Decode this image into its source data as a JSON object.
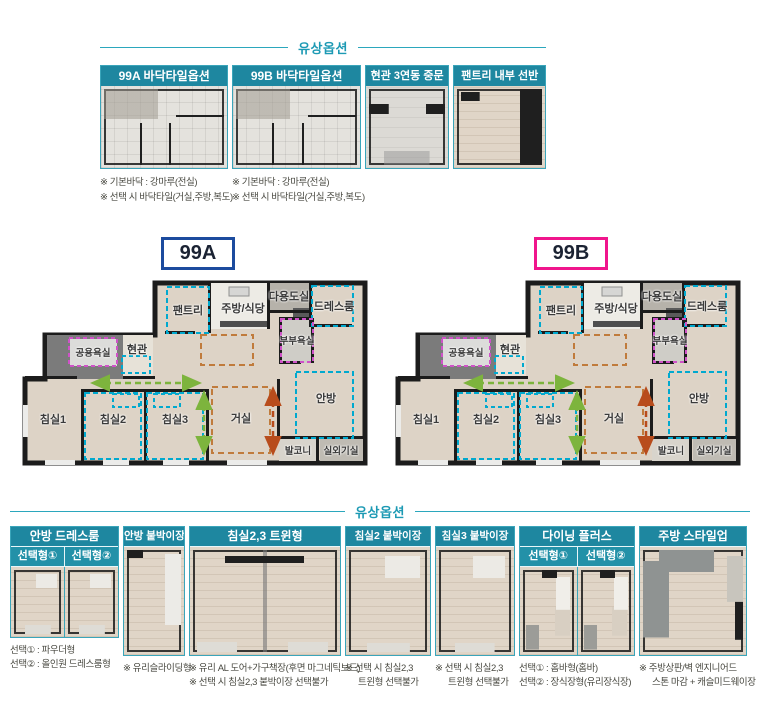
{
  "rooms": {
    "pantry": "팬트리",
    "kitchen": "주방/식당",
    "utility": "다용도실",
    "dress": "드레스룸",
    "master_bath": "부부욕실",
    "common_bath": "공용욕실",
    "entrance": "현관",
    "bed1": "침실1",
    "bed2": "침실2",
    "bed3": "침실3",
    "living": "거실",
    "master": "안방",
    "balcony": "발코니",
    "outdoor_unit": "실외기실"
  },
  "plans": [
    {
      "label": "99A"
    },
    {
      "label": "99B"
    }
  ],
  "top_options": {
    "section_title": "유상옵션",
    "items": [
      {
        "title": "99A 바닥타일옵션"
      },
      {
        "title": "99B 바닥타일옵션"
      },
      {
        "title": "현관 3연동 중문"
      },
      {
        "title": "팬트리 내부 선반"
      }
    ],
    "notes_a": [
      "※ 기본바닥 : 강마루(전실)",
      "※ 선택 시 바닥타일(거실,주방,복도)"
    ],
    "notes_b": [
      "※ 기본바닥 : 강마루(전실)",
      "※ 선택 시 바닥타일(거실,주방,복도)"
    ]
  },
  "bottom_options": {
    "section_title": "유상옵션",
    "items": [
      {
        "title": "안방 드레스룸",
        "tabs": [
          "선택형①",
          "선택형②"
        ],
        "notes": [
          "선택① : 파우더형",
          "선택② : 올인원 드레스룸형"
        ]
      },
      {
        "title": "안방 붙박이장",
        "notes": [
          "※ 유리슬라이딩형"
        ]
      },
      {
        "title": "침실2,3 트윈형",
        "notes": [
          "※ 유리 AL 도어+가구책장(후면 마그네틱보드)",
          "※ 선택 시 침실2,3 붙박이장 선택불가"
        ]
      },
      {
        "title": "침실2 붙박이장",
        "notes": [
          "※ 선택 시 침실2,3",
          "트윈형 선택불가"
        ]
      },
      {
        "title": "침실3 붙박이장",
        "notes": [
          "※ 선택 시 침실2,3",
          "트윈형 선택불가"
        ]
      },
      {
        "title": "다이닝 플러스",
        "tabs": [
          "선택형①",
          "선택형②"
        ],
        "notes": [
          "선택① : 홈바형(홈바)",
          "선택② : 장식장형(유리장식장)"
        ]
      },
      {
        "title": "주방 스타일업",
        "notes": [
          "※ 주방상판/벽 엔지니어드",
          "스톤 마감 + 캐슬미드웨이장"
        ]
      }
    ]
  },
  "colors": {
    "header_teal": "#1e87a0",
    "title_teal": "#1d9ab4",
    "plan_a_border": "#1c4b9e",
    "plan_b_border": "#f0158c",
    "dash_teal": "#00a9cf",
    "dash_magenta": "#cf52c8",
    "dash_orange": "#c07b3c",
    "arrow_green": "#7db43d",
    "arrow_orange": "#b84c1c"
  }
}
